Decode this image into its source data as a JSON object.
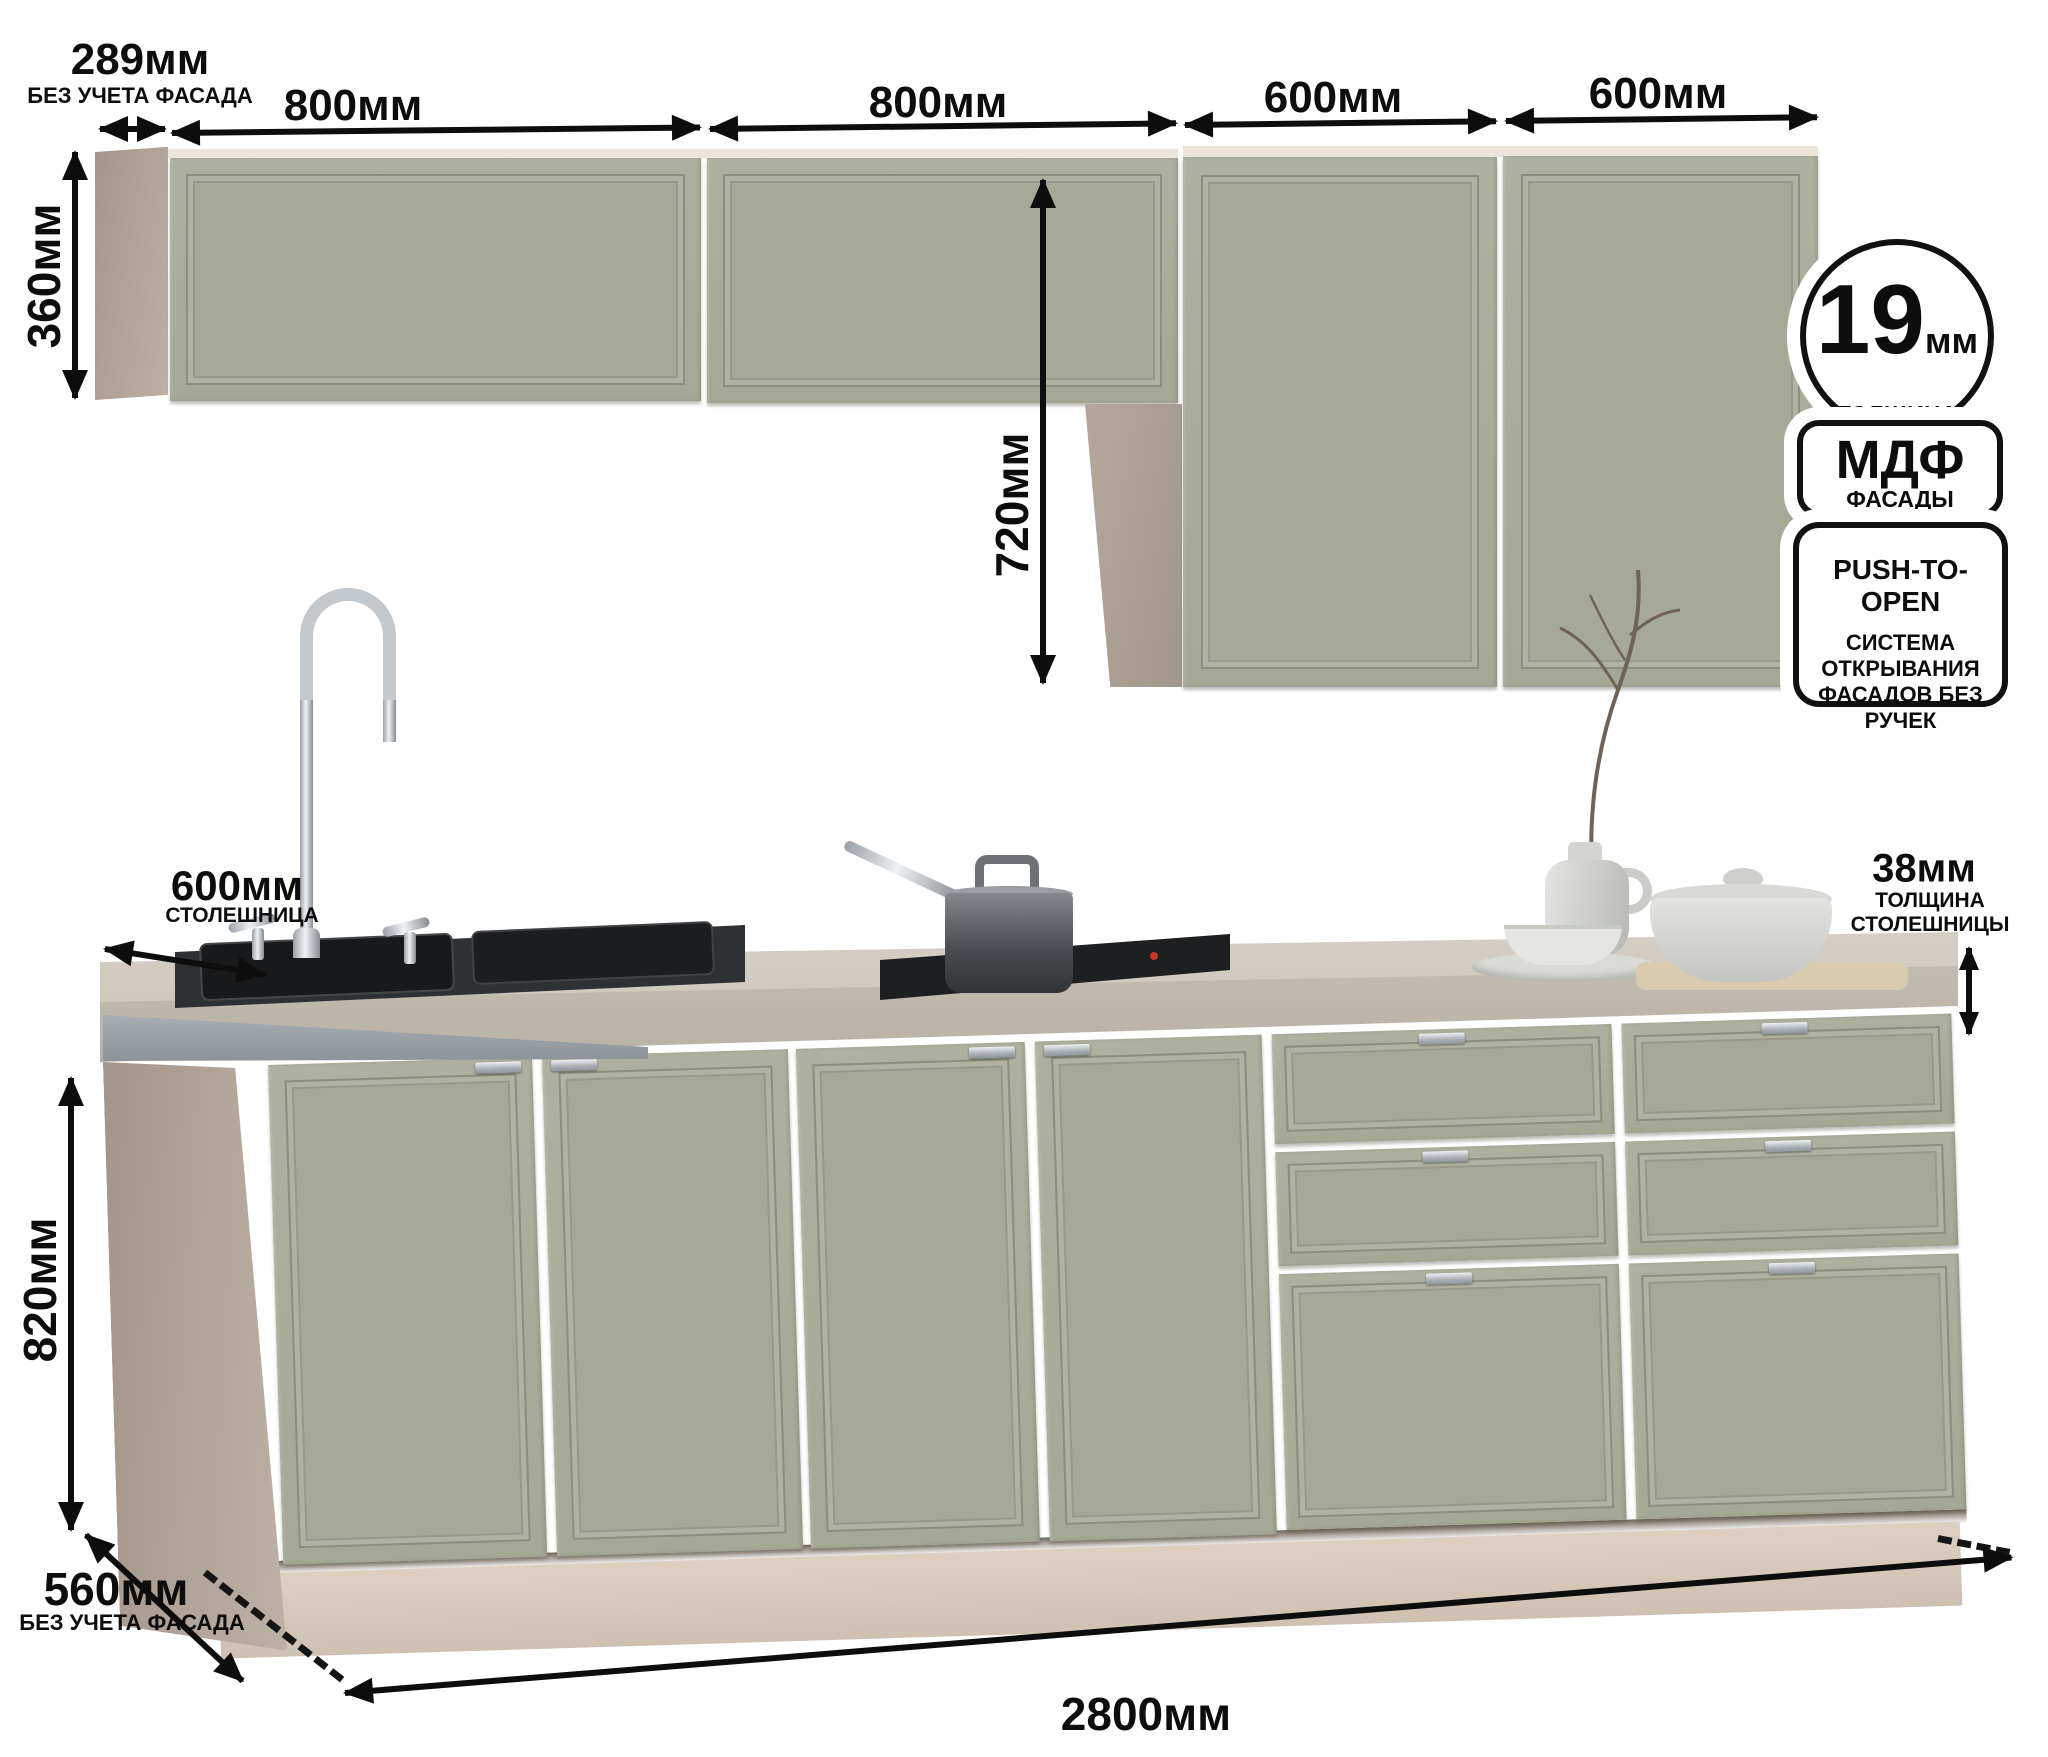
{
  "title": "Схема кухонного гарнитура с размерами",
  "dims": {
    "d289": {
      "value": "289мм",
      "note": "БЕЗ УЧЕТА ФАСАДА"
    },
    "d800a": {
      "value": "800мм"
    },
    "d800b": {
      "value": "800мм"
    },
    "d600a": {
      "value": "600мм"
    },
    "d600b": {
      "value": "600мм"
    },
    "d360": {
      "value": "360мм"
    },
    "d720": {
      "value": "720мм"
    },
    "d600w": {
      "value": "600мм",
      "note": "СТОЛЕШНИЦА"
    },
    "d38": {
      "value": "38мм",
      "note1": "ТОЛЩИНА",
      "note2": "СТОЛЕШНИЦЫ"
    },
    "d820": {
      "value": "820мм"
    },
    "d2800": {
      "value": "2800мм"
    },
    "d560": {
      "value": "560мм",
      "note": "БЕЗ УЧЕТА ФАСАДА"
    }
  },
  "badges": {
    "thickness": {
      "value": "19",
      "unit": "мм",
      "line1": "ТОЛЩИНА",
      "line2": "ФАСАДА"
    },
    "material": {
      "title": "МДФ",
      "subtitle": "ФАСАДЫ"
    },
    "push": {
      "title": "PUSH-TO-OPEN",
      "line1": "СИСТЕМА",
      "line2": "ОТКРЫВАНИЯ",
      "line3": "ФАСАДОВ БЕЗ",
      "line4": "РУЧЕК"
    }
  },
  "colors": {
    "facade": "#a8ab99",
    "carcass": "#b3a69c",
    "plinth": "#d7cabb",
    "countertop": "#cdc7bc",
    "metal_edge": "#97a0a6",
    "sink": "#26292b",
    "ink": "#0d0d0d"
  }
}
